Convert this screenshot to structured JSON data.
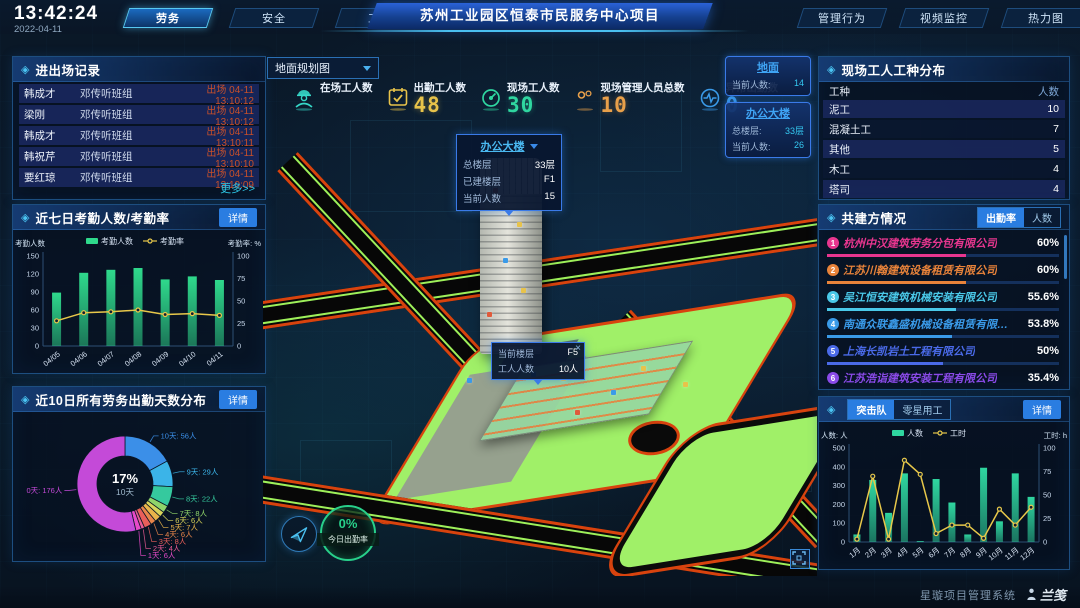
{
  "header": {
    "time": "13:42:24",
    "date": "2022-04-11",
    "tabs_left": [
      "劳务",
      "安全",
      "工期"
    ],
    "title": "苏州工业园区恒泰市民服务中心项目",
    "tabs_right": [
      "管理行为",
      "视频监控",
      "热力图"
    ]
  },
  "panels": {
    "entry": {
      "title": "进出场记录",
      "more": "更多>>",
      "rows": [
        {
          "name": "韩成才",
          "group": "邓传听班组",
          "event": "出场 04-11 13:10:12"
        },
        {
          "name": "梁刚",
          "group": "邓传听班组",
          "event": "出场 04-11 13:10:12"
        },
        {
          "name": "韩成才",
          "group": "邓传听班组",
          "event": "出场 04-11 13:10:11"
        },
        {
          "name": "韩祝芹",
          "group": "邓传听班组",
          "event": "出场 04-11 13:10:10"
        },
        {
          "name": "要红琼",
          "group": "邓传听班组",
          "event": "出场 04-11 13:10:09"
        }
      ]
    },
    "attendance": {
      "title": "近七日考勤人数/考勤率",
      "detail": "详情"
    },
    "days": {
      "title": "近10日所有劳务出勤天数分布",
      "detail": "详情"
    },
    "trades": {
      "title": "现场工人工种分布",
      "columns": [
        "工种",
        "人数"
      ],
      "rows": [
        [
          "泥工",
          "10"
        ],
        [
          "混凝土工",
          "7"
        ],
        [
          "其他",
          "5"
        ],
        [
          "木工",
          "4"
        ],
        [
          "塔司",
          "4"
        ]
      ]
    },
    "partners": {
      "title": "共建方情况",
      "tabs": [
        "出勤率",
        "人数"
      ],
      "active_tab": 0,
      "items": [
        {
          "name": "杭州中汉建筑劳务分包有限公司",
          "percent": "60%",
          "color": "#e8368f"
        },
        {
          "name": "江苏川翰建筑设备租赁有限公司",
          "percent": "60%",
          "color": "#e8833a"
        },
        {
          "name": "吴江恒安建筑机械安装有限公司",
          "percent": "55.6%",
          "color": "#4ac8e8"
        },
        {
          "name": "南通众联鑫盛机械设备租赁有限公司",
          "percent": "53.8%",
          "color": "#3a9ae8"
        },
        {
          "name": "上海长凯岩土工程有限公司",
          "percent": "50%",
          "color": "#4a6ae8"
        },
        {
          "name": "江苏浩诣建筑安装工程有限公司",
          "percent": "35.4%",
          "color": "#8a4ae8"
        }
      ]
    },
    "squad": {
      "tabs": [
        "突击队",
        "零星用工"
      ],
      "active_tab": 0,
      "detail": "详情"
    }
  },
  "stats": [
    {
      "label": "在场工人数",
      "value": "",
      "color": "#35d8c8",
      "icon": "worker"
    },
    {
      "label": "出勤工人数",
      "value": "48",
      "color": "#e8c34a",
      "icon": "calendar-check"
    },
    {
      "label": "现场工人数",
      "value": "30",
      "color": "#2fd6a0",
      "icon": "gauge"
    },
    {
      "label": "现场管理人员总数",
      "value": "10",
      "color": "#e8a04a",
      "icon": "people"
    },
    {
      "label": "异常出勤数",
      "value": "0",
      "color": "#3a9ae8",
      "icon": "pulse"
    }
  ],
  "map": {
    "view_selector": {
      "value": "地面规划图"
    },
    "building_tooltip": {
      "title": "办公大楼",
      "rows": [
        {
          "label": "总楼层",
          "value": "33层"
        },
        {
          "label": "已建楼层",
          "value": "F1"
        },
        {
          "label": "当前人数",
          "value": "15"
        }
      ]
    },
    "floor_tooltip": {
      "close": "×",
      "rows": [
        {
          "label": "当前楼层",
          "value": "F5"
        },
        {
          "label": "工人人数",
          "value": "10人"
        }
      ]
    },
    "zone_cards": [
      {
        "title": "地面",
        "rows": [
          {
            "label": "当前人数:",
            "value": "14"
          }
        ]
      },
      {
        "title": "办公大楼",
        "rows": [
          {
            "label": "总楼层:",
            "value": "33层"
          },
          {
            "label": "当前人数:",
            "value": "26"
          }
        ]
      }
    ],
    "gauge": {
      "value": "0%",
      "label": "今日出勤率"
    }
  },
  "chart_data": [
    {
      "id": "attendance",
      "type": "bar-line",
      "title": "近七日考勤人数/考勤率",
      "categories": [
        "04/05",
        "04/06",
        "04/07",
        "04/08",
        "04/09",
        "04/10",
        "04/11"
      ],
      "series": [
        {
          "name": "考勤人数",
          "type": "bar",
          "axis": "left",
          "color": "#2fd98c",
          "values": [
            89,
            122,
            127,
            130,
            111,
            116,
            110
          ]
        },
        {
          "name": "考勤率",
          "type": "line",
          "axis": "right",
          "color": "#e8c84a",
          "values": [
            28,
            37,
            38,
            40,
            35,
            36,
            34
          ]
        }
      ],
      "left_axis": {
        "label": "考勤人数",
        "min": 0,
        "max": 150,
        "step": 30
      },
      "right_axis": {
        "label": "考勤率: %",
        "min": 0,
        "max": 100,
        "step": 25
      },
      "legend_position": "top",
      "grid": false
    },
    {
      "id": "attendance_days",
      "type": "donut",
      "title": "近10日所有劳务出勤天数分布",
      "center": {
        "percent": "17%",
        "label": "10天"
      },
      "unit": "人",
      "slices": [
        {
          "label": "10天",
          "count": 56,
          "color": "#3b8fe8"
        },
        {
          "label": "9天",
          "count": 29,
          "color": "#3bb4e8"
        },
        {
          "label": "8天",
          "count": 22,
          "color": "#35c99e"
        },
        {
          "label": "7天",
          "count": 8,
          "color": "#8fd46a"
        },
        {
          "label": "6天",
          "count": 6,
          "color": "#d8d45a"
        },
        {
          "label": "5天",
          "count": 7,
          "color": "#e8b44a"
        },
        {
          "label": "4天",
          "count": 6,
          "color": "#e8854a"
        },
        {
          "label": "3天",
          "count": 8,
          "color": "#e85f5a"
        },
        {
          "label": "2天",
          "count": 4,
          "color": "#e85a93"
        },
        {
          "label": "1天",
          "count": 6,
          "color": "#e84ac8"
        },
        {
          "label": "0天",
          "count": 176,
          "color": "#c44ad8"
        }
      ]
    },
    {
      "id": "squad",
      "type": "bar-line",
      "title": "突击队",
      "categories": [
        "1月",
        "2月",
        "3月",
        "4月",
        "5月",
        "6月",
        "7月",
        "8月",
        "9月",
        "10月",
        "11月",
        "12月"
      ],
      "series": [
        {
          "name": "人数",
          "type": "bar",
          "axis": "left",
          "color": "#2fd6a0",
          "values": [
            40,
            330,
            155,
            365,
            5,
            335,
            210,
            40,
            395,
            110,
            365,
            240
          ]
        },
        {
          "name": "工时",
          "type": "line",
          "axis": "right",
          "color": "#e8c84a",
          "values": [
            3,
            70,
            3,
            87,
            72,
            9,
            18,
            18,
            4,
            35,
            18,
            37
          ]
        }
      ],
      "left_axis": {
        "label": "人数: 人",
        "min": 0,
        "max": 500,
        "step": 100
      },
      "right_axis": {
        "label": "工时: h",
        "min": 0,
        "max": 100,
        "step": 25
      },
      "legend_position": "top",
      "grid": false
    }
  ],
  "footer": {
    "system_name": "星璇项目管理系统",
    "logo_text": "兰笺"
  }
}
